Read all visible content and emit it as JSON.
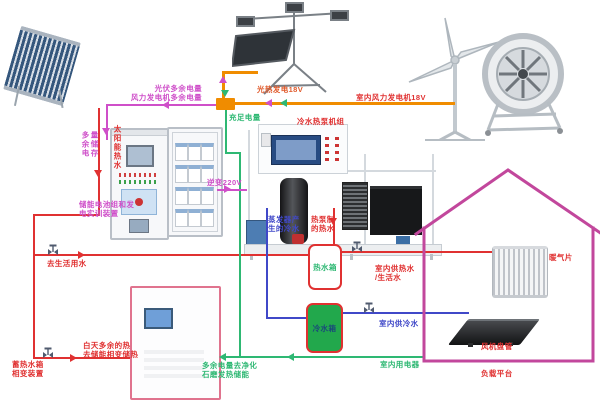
{
  "colors": {
    "pipe_red": "#e03131",
    "pipe_blue": "#4048c8",
    "wire_green": "#2eb873",
    "wire_orange": "#f08c00",
    "wire_magenta": "#cf4fc9",
    "house_outline": "#c2479c",
    "tank_green_fill": "#22a84c",
    "label_orange_red": "#e05a2b",
    "label_navy": "#1a4a7a"
  },
  "labels": {
    "solar_hot_water": "太阳能热水",
    "pv_wind_surplus": "光伏多余电量\n风力发电机多余电量",
    "surplus_storage": "多余电量储存",
    "battery_device": "储能电池组和发\n电实训装置",
    "sufficient_power": "充足电量",
    "inverter_220v": "逆变220V",
    "pv_thermal_18v": "光热发电18V",
    "indoor_wind_18v": "室内风力发电机18V",
    "heat_pump_unit": "冷水热泵机组",
    "evaporator_cold_water": "蒸发器产\n生的冷水",
    "heat_pump_hot_water": "热泵制\n的热水",
    "to_domestic_water": "去生活用水",
    "daytime_surplus_heat": "白天多余的热\n去储能相变储热",
    "thermal_storage_device": "蓄热水箱\n相变装置",
    "surplus_to_purify": "多余电量去净化\n石磨发热储能",
    "indoor_appliances": "室内用电器",
    "hot_water_tank": "热水箱",
    "cold_water_tank": "冷水箱",
    "indoor_hot_water": "室内供热水\n/生活水",
    "indoor_cold_water": "室内供冷水",
    "radiator": "暖气片",
    "fan_coil": "风机盘管",
    "load_platform": "负载平台"
  }
}
